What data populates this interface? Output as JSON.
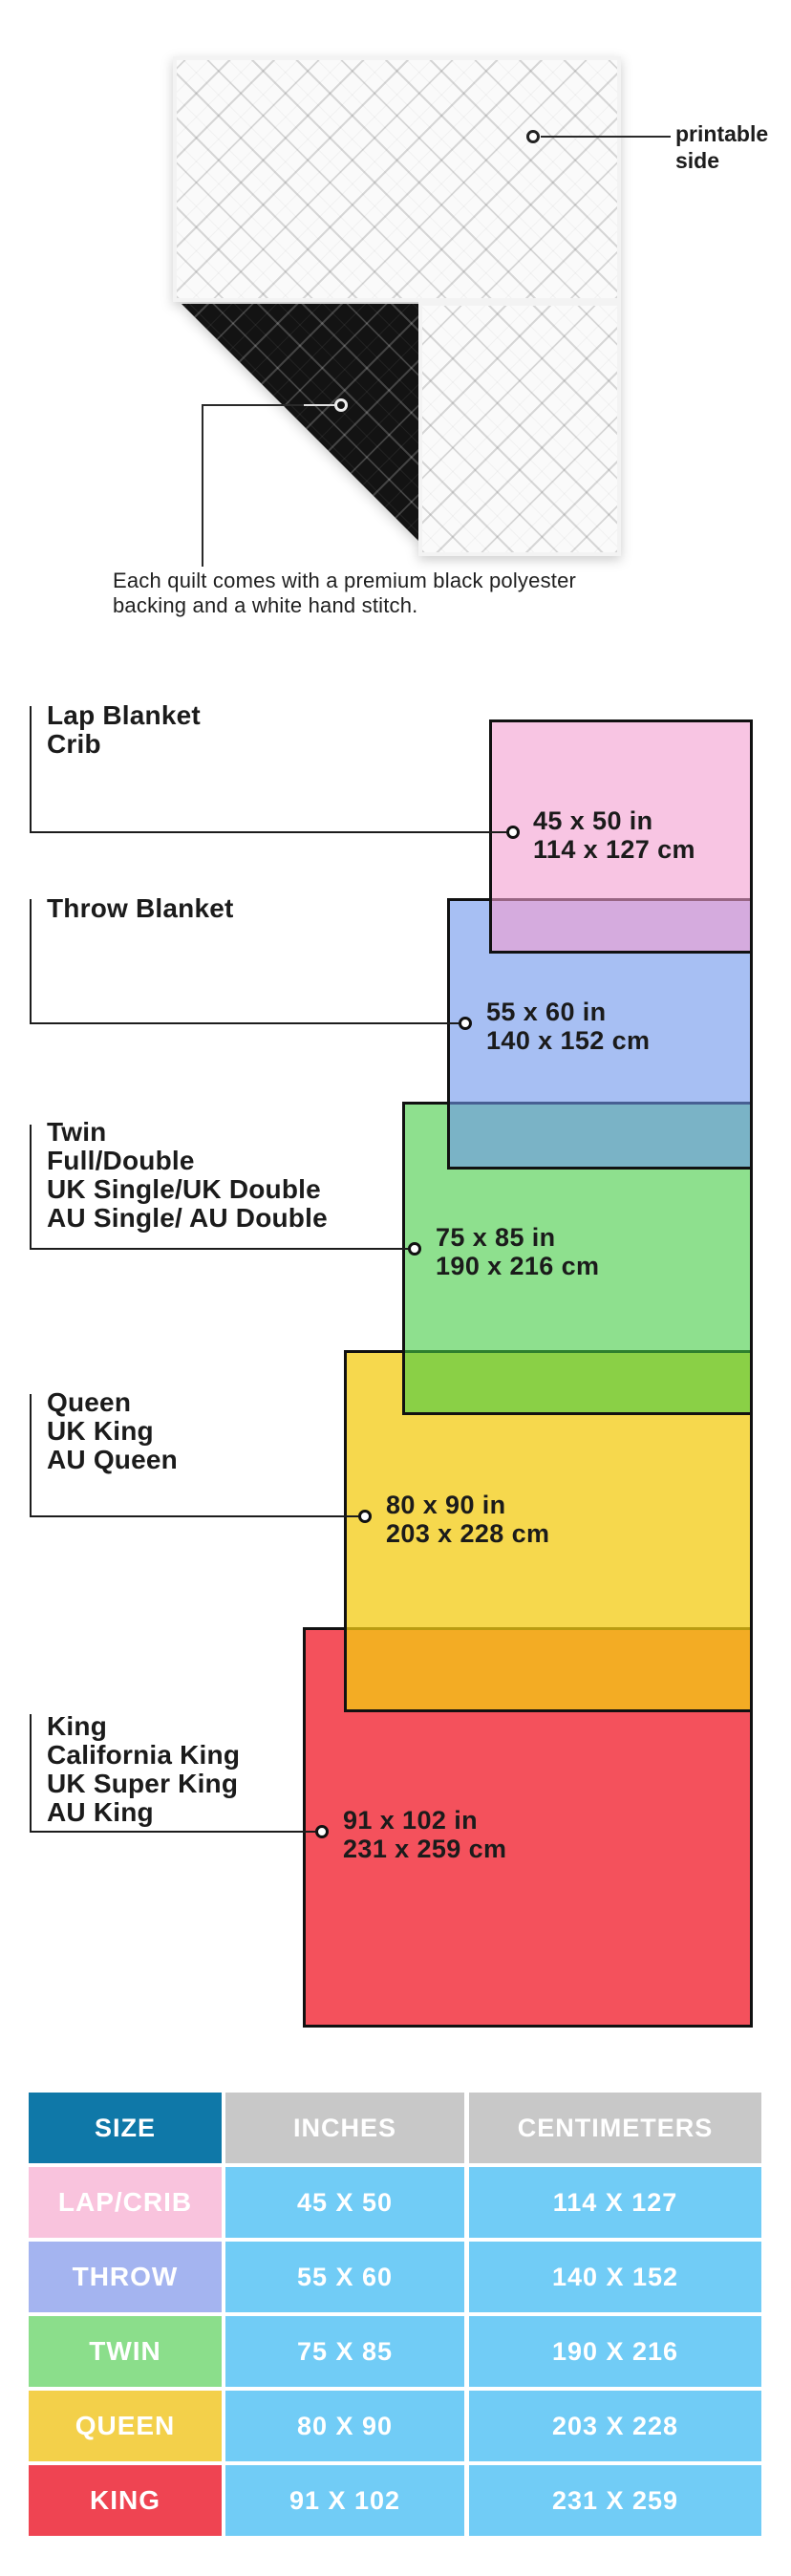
{
  "quilt": {
    "printable_label_lines": [
      "printable",
      "side"
    ],
    "caption_lines": [
      "Each quilt comes with a premium black polyester",
      "backing and a white hand stitch."
    ],
    "front_color": "#fafafa",
    "backing_color": "#131313"
  },
  "diagram": {
    "border_color": "#111111",
    "sizes": [
      {
        "key": "lap-crib",
        "labels": [
          "Lap Blanket",
          "Crib"
        ],
        "dim_in": "45 x 50 in",
        "dim_cm": "114 x 127 cm",
        "fill": "rgba(243,158,208,0.6)"
      },
      {
        "key": "throw",
        "labels": [
          "Throw Blanket"
        ],
        "dim_in": "55 x 60 in",
        "dim_cm": "140 x 152 cm",
        "fill": "rgba(108,148,235,0.6)"
      },
      {
        "key": "twin",
        "labels": [
          "Twin",
          "Full/Double",
          "UK Single/UK Double",
          "AU Single/ AU Double"
        ],
        "dim_in": "75 x 85 in",
        "dim_cm": "190 x 216 cm",
        "fill": "rgba(67,203,67,0.6)"
      },
      {
        "key": "queen",
        "labels": [
          "Queen",
          "UK King",
          "AU Queen"
        ],
        "dim_in": "80 x 90 in",
        "dim_cm": "203 x 228 cm",
        "fill": "rgba(243,203,18,0.75)"
      },
      {
        "key": "king",
        "labels": [
          "King",
          "California King",
          "UK Super King",
          "AU King"
        ],
        "dim_in": "91 x 102 in",
        "dim_cm": "231 x 259 cm",
        "fill": "rgba(242,50,63,0.85)"
      }
    ]
  },
  "table": {
    "headers": [
      "SIZE",
      "INCHES",
      "CENTIMETERS"
    ],
    "header_size_bg": "#0F78A8",
    "header_other_bg": "#C8C8C8",
    "value_cell_bg": "#71CCF6",
    "rows": [
      {
        "size": "LAP/CRIB",
        "inches": "45 X 50",
        "cm": "114 X 127",
        "color": "#F9C3DD"
      },
      {
        "size": "THROW",
        "inches": "55 X 60",
        "cm": "140 X 152",
        "color": "#A4B4F0"
      },
      {
        "size": "TWIN",
        "inches": "75 X 85",
        "cm": "190 X 216",
        "color": "#8BDE8B"
      },
      {
        "size": "QUEEN",
        "inches": "80 X 90",
        "cm": "203 X 228",
        "color": "#F3D04A"
      },
      {
        "size": "KING",
        "inches": "91 X 102",
        "cm": "231 X 259",
        "color": "#EF4452"
      }
    ]
  }
}
